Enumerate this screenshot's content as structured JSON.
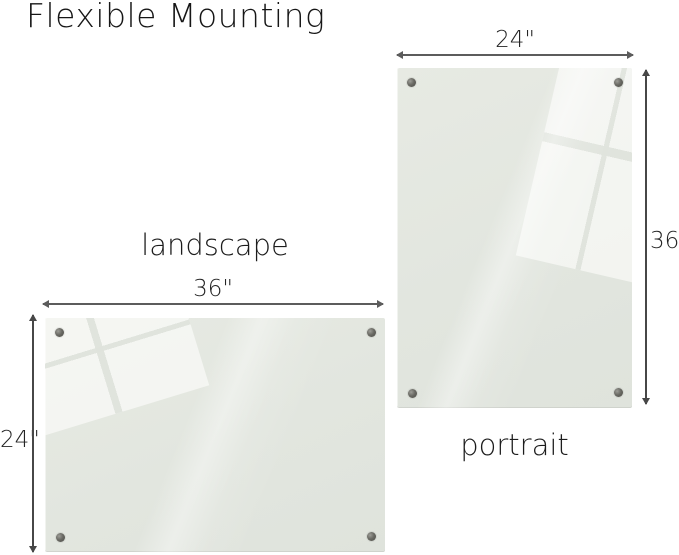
{
  "title": "Flexible Mounting",
  "boards": {
    "landscape": {
      "label": "landscape",
      "width_label": "36\"",
      "height_label": "24\""
    },
    "portrait": {
      "label": "portrait",
      "width_label": "24\"",
      "height_label": "36\""
    }
  },
  "colors": {
    "background": "#ffffff",
    "board_glass": "#e2e6df",
    "board_reflection": "#f6f7f4",
    "dimension_line": "#5c5c5c",
    "text": "#1c1c1c",
    "screw": "#55544e"
  }
}
